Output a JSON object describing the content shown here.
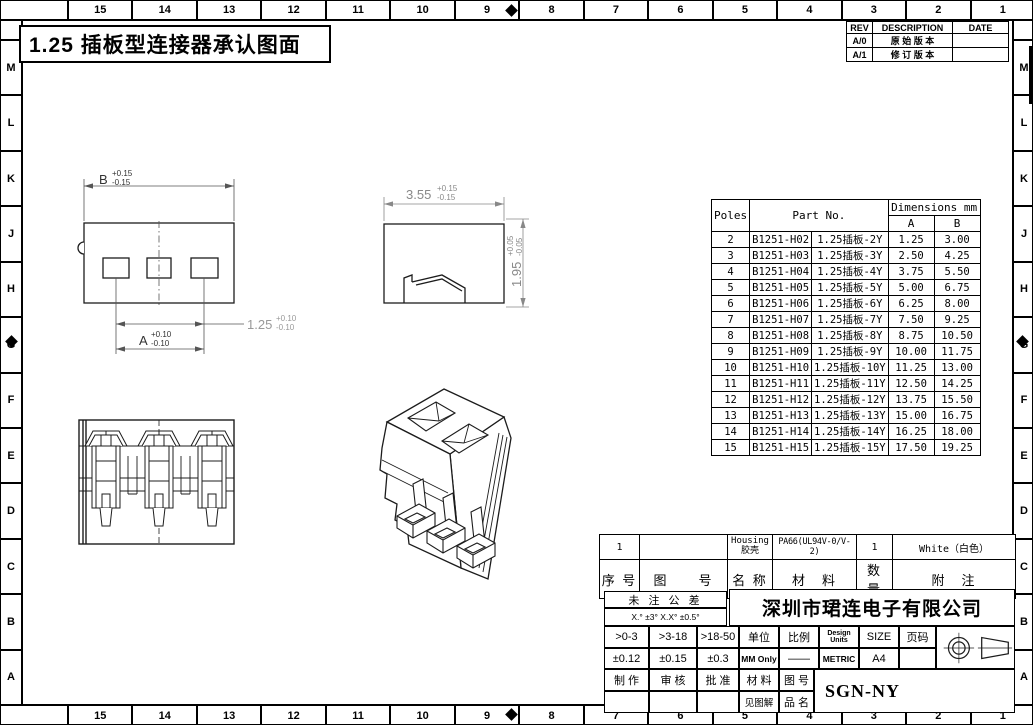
{
  "title": "1.25 插板型连接器承认图面",
  "border": {
    "top_numbers": [
      "15",
      "14",
      "13",
      "12",
      "11",
      "10",
      "9",
      "8",
      "7",
      "6",
      "5",
      "4",
      "3",
      "2",
      "1"
    ],
    "side_letters": [
      "M",
      "L",
      "K",
      "J",
      "H",
      "G",
      "F",
      "E",
      "D",
      "C",
      "B",
      "A"
    ]
  },
  "revision_table": {
    "headers": [
      "REV",
      "DESCRIPTION",
      "DATE"
    ],
    "rows": [
      [
        "A/0",
        "原 始 版 本",
        ""
      ],
      [
        "A/1",
        "修 订 版 本",
        ""
      ]
    ]
  },
  "parts_table": {
    "col_poles": "Poles",
    "col_part_no": "Part No.",
    "col_dims": "Dimensions mm",
    "col_a": "A",
    "col_b": "B",
    "rows": [
      [
        "2",
        "B1251-H02",
        "1.25插板-2Y",
        "1.25",
        "3.00"
      ],
      [
        "3",
        "B1251-H03",
        "1.25插板-3Y",
        "2.50",
        "4.25"
      ],
      [
        "4",
        "B1251-H04",
        "1.25插板-4Y",
        "3.75",
        "5.50"
      ],
      [
        "5",
        "B1251-H05",
        "1.25插板-5Y",
        "5.00",
        "6.75"
      ],
      [
        "6",
        "B1251-H06",
        "1.25插板-6Y",
        "6.25",
        "8.00"
      ],
      [
        "7",
        "B1251-H07",
        "1.25插板-7Y",
        "7.50",
        "9.25"
      ],
      [
        "8",
        "B1251-H08",
        "1.25插板-8Y",
        "8.75",
        "10.50"
      ],
      [
        "9",
        "B1251-H09",
        "1.25插板-9Y",
        "10.00",
        "11.75"
      ],
      [
        "10",
        "B1251-H10",
        "1.25插板-10Y",
        "11.25",
        "13.00"
      ],
      [
        "11",
        "B1251-H11",
        "1.25插板-11Y",
        "12.50",
        "14.25"
      ],
      [
        "12",
        "B1251-H12",
        "1.25插板-12Y",
        "13.75",
        "15.50"
      ],
      [
        "13",
        "B1251-H13",
        "1.25插板-13Y",
        "15.00",
        "16.75"
      ],
      [
        "14",
        "B1251-H14",
        "1.25插板-14Y",
        "16.25",
        "18.00"
      ],
      [
        "15",
        "B1251-H15",
        "1.25插板-15Y",
        "17.50",
        "19.25"
      ]
    ]
  },
  "dims": {
    "front_width": {
      "label": "B",
      "plus": "+0.15",
      "minus": "-0.15"
    },
    "front_pitch": {
      "label": "1.25",
      "plus": "+0.10",
      "minus": "-0.10"
    },
    "front_a": {
      "label": "A",
      "plus": "+0.10",
      "minus": "-0.10"
    },
    "side_width": {
      "label": "3.55",
      "plus": "+0.15",
      "minus": "-0.15"
    },
    "side_height": {
      "label": "1.95",
      "plus": "+0.05",
      "minus": "-0.05"
    }
  },
  "bom": {
    "seq_value": "1",
    "drawing_no_value": "",
    "name_en": "Housing",
    "name_cn": "胶壳",
    "material_value": "PA66(UL94V-0/V-2)",
    "qty_value": "1",
    "note_value": "White（白色）",
    "headers": [
      "序 号",
      "图　　号",
      "名 称",
      "材　料",
      "数 量",
      "附　注"
    ]
  },
  "title_block": {
    "tolerance_title": "未 注 公 差",
    "tolerance_angles": "X.° ±3°  X.X° ±0.5°",
    "company": "深圳市珺连电子有限公司",
    "range_headers": [
      ">0-3",
      ">3-18",
      ">18-50"
    ],
    "range_values": [
      "±0.12",
      "±0.15",
      "±0.3"
    ],
    "unit_label": "单位",
    "unit_value": "MM Only",
    "scale_label": "比例",
    "scale_value": "——",
    "design_units_label": "Design Units",
    "design_units_value": "METRIC",
    "size_label": "SIZE",
    "size_value": "A4",
    "page_label": "页码",
    "page_value": "",
    "maker_label": "制 作",
    "checker_label": "审 核",
    "approver_label": "批 准",
    "material_label": "材 料",
    "material_value": "见图解",
    "drawing_no_label": "图 号",
    "product_name_label": "品 名",
    "drawing_code": "SGN-NY"
  }
}
